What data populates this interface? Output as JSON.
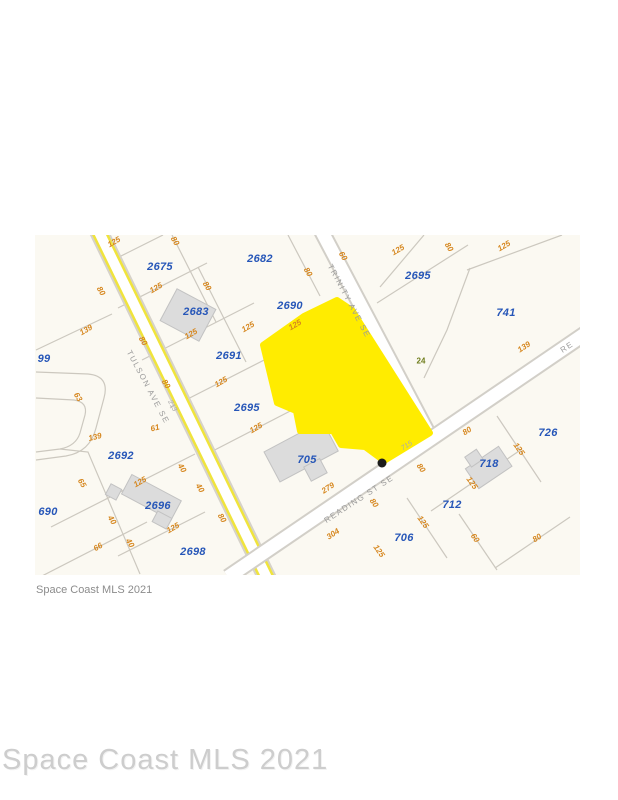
{
  "watermark_small": "Space Coast MLS 2021",
  "watermark_large": "Space Coast MLS 2021",
  "map": {
    "highlight_color": "#ffec00",
    "parcel_number_color": "#2656b8",
    "dimension_color": "#d6871f",
    "street_label_color": "#9b9b9b",
    "streets": [
      {
        "label": "TULSON AVE SE",
        "x": 148,
        "y": 387,
        "rot": 62
      },
      {
        "label": "TRINITY AVE SE",
        "x": 349,
        "y": 301,
        "rot": 62
      },
      {
        "label": "READING ST SE",
        "x": 359,
        "y": 499,
        "rot": -33
      },
      {
        "label": "RE",
        "x": 567,
        "y": 347,
        "rot": -33
      }
    ],
    "parcels": [
      {
        "label": "99",
        "x": 44,
        "y": 359
      },
      {
        "label": "2675",
        "x": 160,
        "y": 267
      },
      {
        "label": "2682",
        "x": 260,
        "y": 259
      },
      {
        "label": "2683",
        "x": 196,
        "y": 312
      },
      {
        "label": "2690",
        "x": 290,
        "y": 306
      },
      {
        "label": "2691",
        "x": 229,
        "y": 356
      },
      {
        "label": "2695",
        "x": 418,
        "y": 276
      },
      {
        "label": "741",
        "x": 506,
        "y": 313
      },
      {
        "label": "2695",
        "x": 247,
        "y": 408
      },
      {
        "label": "705",
        "x": 307,
        "y": 460
      },
      {
        "label": "2692",
        "x": 121,
        "y": 456
      },
      {
        "label": "690",
        "x": 48,
        "y": 512
      },
      {
        "label": "2696",
        "x": 158,
        "y": 506
      },
      {
        "label": "2698",
        "x": 193,
        "y": 552
      },
      {
        "label": "706",
        "x": 404,
        "y": 538
      },
      {
        "label": "712",
        "x": 452,
        "y": 505
      },
      {
        "label": "718",
        "x": 489,
        "y": 464
      },
      {
        "label": "726",
        "x": 548,
        "y": 433
      }
    ],
    "dimensions": [
      {
        "label": "125",
        "x": 114,
        "y": 242,
        "rot": -30
      },
      {
        "label": "80",
        "x": 175,
        "y": 241,
        "rot": 58
      },
      {
        "label": "80",
        "x": 308,
        "y": 272,
        "rot": 58
      },
      {
        "label": "60",
        "x": 343,
        "y": 256,
        "rot": 58
      },
      {
        "label": "125",
        "x": 398,
        "y": 250,
        "rot": -30
      },
      {
        "label": "80",
        "x": 449,
        "y": 247,
        "rot": 58
      },
      {
        "label": "125",
        "x": 504,
        "y": 246,
        "rot": -30
      },
      {
        "label": "80",
        "x": 101,
        "y": 291,
        "rot": 58
      },
      {
        "label": "125",
        "x": 156,
        "y": 288,
        "rot": -30
      },
      {
        "label": "80",
        "x": 207,
        "y": 286,
        "rot": 58
      },
      {
        "label": "139",
        "x": 86,
        "y": 330,
        "rot": -30
      },
      {
        "label": "125",
        "x": 191,
        "y": 334,
        "rot": -30
      },
      {
        "label": "80",
        "x": 143,
        "y": 341,
        "rot": 58
      },
      {
        "label": "125",
        "x": 248,
        "y": 327,
        "rot": -30
      },
      {
        "label": "125",
        "x": 295,
        "y": 325,
        "rot": -30
      },
      {
        "label": "80",
        "x": 166,
        "y": 384,
        "rot": 58
      },
      {
        "label": "125",
        "x": 221,
        "y": 382,
        "rot": -30
      },
      {
        "label": "63",
        "x": 78,
        "y": 397,
        "rot": 58
      },
      {
        "label": "125",
        "x": 256,
        "y": 428,
        "rot": -30
      },
      {
        "label": "139",
        "x": 95,
        "y": 437,
        "rot": -14
      },
      {
        "label": "61",
        "x": 155,
        "y": 428,
        "rot": -14
      },
      {
        "label": "65",
        "x": 82,
        "y": 483,
        "rot": 58
      },
      {
        "label": "125",
        "x": 140,
        "y": 482,
        "rot": -30
      },
      {
        "label": "40",
        "x": 182,
        "y": 468,
        "rot": 58
      },
      {
        "label": "40",
        "x": 200,
        "y": 488,
        "rot": 58
      },
      {
        "label": "40",
        "x": 112,
        "y": 520,
        "rot": 58
      },
      {
        "label": "125",
        "x": 173,
        "y": 528,
        "rot": -30
      },
      {
        "label": "80",
        "x": 222,
        "y": 518,
        "rot": 58
      },
      {
        "label": "40",
        "x": 130,
        "y": 543,
        "rot": 58
      },
      {
        "label": "66",
        "x": 98,
        "y": 547,
        "rot": -30
      },
      {
        "label": "279",
        "x": 328,
        "y": 488,
        "rot": -33
      },
      {
        "label": "304",
        "x": 333,
        "y": 534,
        "rot": -33
      },
      {
        "label": "80",
        "x": 374,
        "y": 503,
        "rot": 55
      },
      {
        "label": "125",
        "x": 379,
        "y": 551,
        "rot": 55
      },
      {
        "label": "125",
        "x": 423,
        "y": 522,
        "rot": 55
      },
      {
        "label": "80",
        "x": 421,
        "y": 468,
        "rot": 55
      },
      {
        "label": "139",
        "x": 524,
        "y": 347,
        "rot": -33
      },
      {
        "label": "80",
        "x": 467,
        "y": 431,
        "rot": -33
      },
      {
        "label": "125",
        "x": 472,
        "y": 483,
        "rot": 55
      },
      {
        "label": "125",
        "x": 519,
        "y": 449,
        "rot": 55
      },
      {
        "label": "60",
        "x": 475,
        "y": 538,
        "rot": 55
      },
      {
        "label": "80",
        "x": 537,
        "y": 538,
        "rot": -33
      }
    ],
    "gray_refs": [
      {
        "label": "213",
        "x": 172,
        "y": 406,
        "rot": 62
      },
      {
        "label": "715",
        "x": 407,
        "y": 446,
        "rot": -33
      }
    ],
    "green_marker": {
      "label": "24",
      "x": 421,
      "y": 361
    }
  }
}
